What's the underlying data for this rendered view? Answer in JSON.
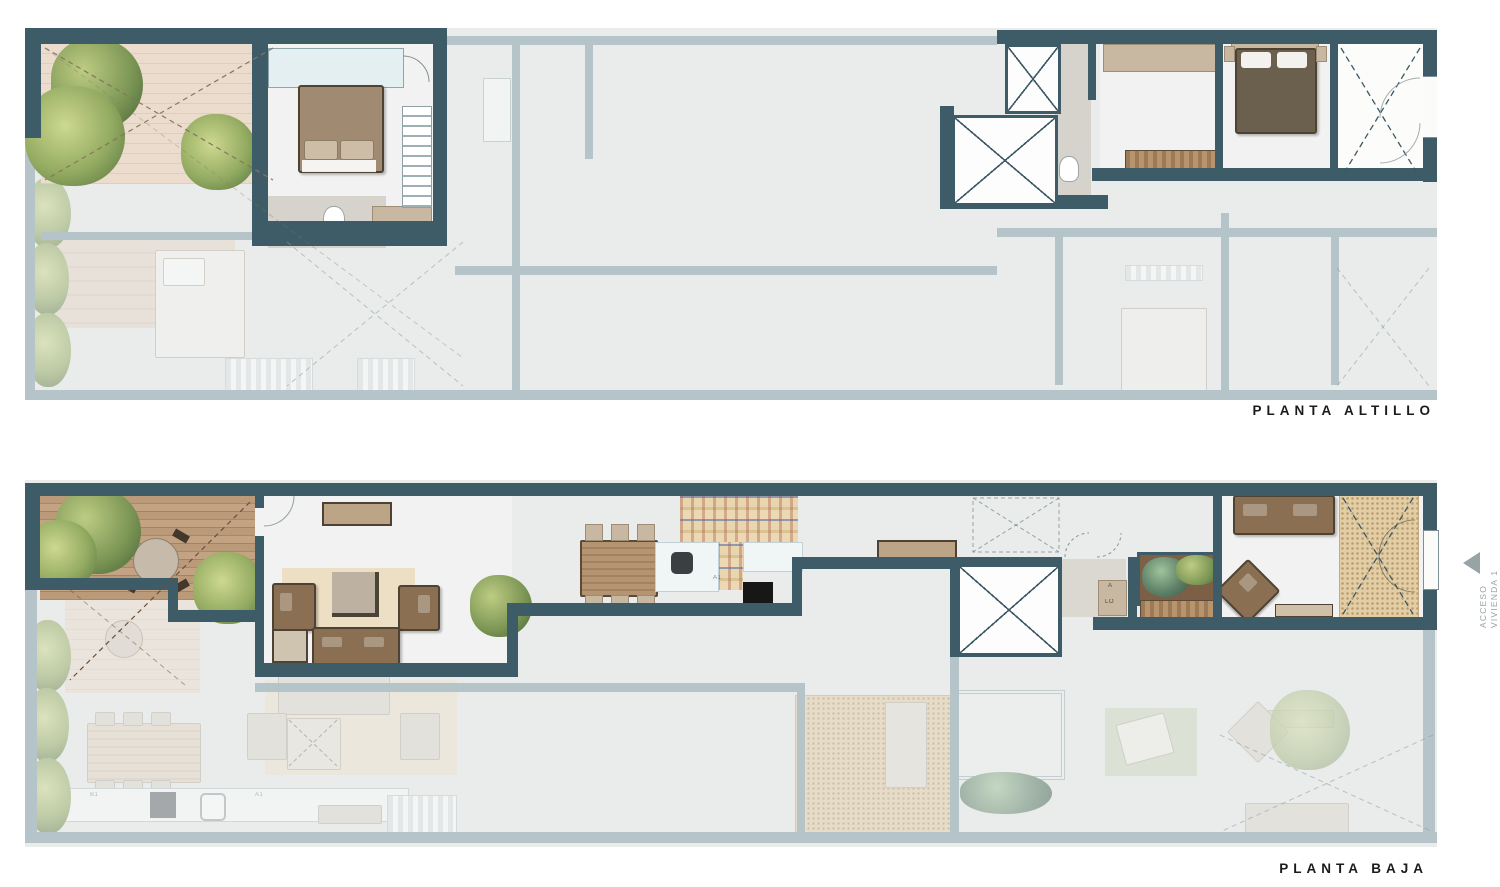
{
  "page": {
    "background": "#ffffff",
    "width": 1500,
    "height": 887
  },
  "colors": {
    "wall_dark": "#3e5b68",
    "wall_faded": "#b4c4c8",
    "floor": "#eaecec",
    "floor_bright": "#f1f2f1",
    "floor_warm": "#d6d3cc",
    "deck_wood": "#b29071",
    "deck_pale": "#e8d8c8",
    "plant_light": "#a3b873",
    "plant_dark": "#5c7a44",
    "plant_teal": "#5f8168",
    "furn_brown": "#8a6f52",
    "furn_dark": "#5f5545",
    "furn_tan": "#c8b8a2",
    "rug_beige": "#ecdfc3",
    "mosaic_tile": "#e2cda4",
    "skylight_blue": "#e4eff1",
    "counter_white": "#f0f5f6",
    "stove_black": "#171717",
    "label_ink": "#1b1b1b",
    "annotation_gray": "#98a3a6"
  },
  "plans": [
    {
      "id": "altillo",
      "label": "PLANTA ALTILLO"
    },
    {
      "id": "baja",
      "label": "PLANTA BAJA"
    }
  ],
  "annotations": {
    "access_line1": "ACCESO",
    "access_line2": "VIVIENDA 1",
    "unit_label_a1": "A1",
    "unit_label_b1": "B1",
    "tiny_a": "A",
    "tiny_lo": "LO"
  },
  "icons": {
    "access_arrow": "left-triangle"
  }
}
